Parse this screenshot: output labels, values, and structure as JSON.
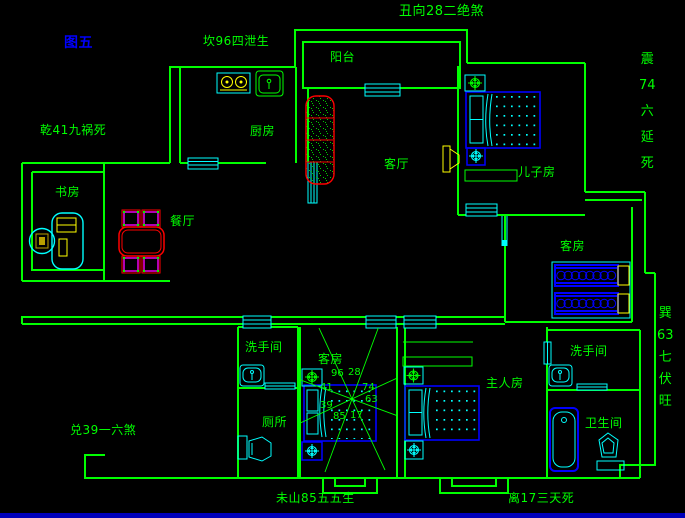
{
  "figure_label": "图五",
  "fengshui_labels": {
    "kan": "坎96四泄生",
    "chou": "丑向28二绝煞",
    "qian": "乾41九祸死",
    "dui": "兑39一六煞",
    "wei": "未山85五五生",
    "li": "离17三天死",
    "zhen": [
      "震",
      "74",
      "六",
      "延",
      "死"
    ],
    "xun": [
      "巽",
      "63",
      "七",
      "伏",
      "旺"
    ]
  },
  "rooms": {
    "balcony": "阳台",
    "kitchen": "厨房",
    "living_room": "客厅",
    "sons_room": "儿子房",
    "study": "书房",
    "dining_room": "餐厅",
    "guest_room_east": "客房",
    "guest_room_center": "客房",
    "washroom_west": "洗手间",
    "washroom_east": "洗手间",
    "toilet": "厕所",
    "master_room": "主人房",
    "bathroom": "卫生间"
  },
  "compass_numbers": {
    "top_left": "96",
    "top_right": "28",
    "left_upper": "41",
    "right_upper": "74",
    "left_lower": "39",
    "right_lower": "63",
    "bottom_left": "85",
    "bottom_right": "17"
  },
  "colors": {
    "background": "#000000",
    "wall_green": "#00ff00",
    "window_cyan": "#00ffff",
    "furniture_blue": "#0000ff",
    "accent_yellow": "#ffff00",
    "accent_red": "#ff0000",
    "accent_magenta": "#ff00ff",
    "figure_label_blue": "#0000ff",
    "bottom_bar_blue": "#0000bb"
  }
}
